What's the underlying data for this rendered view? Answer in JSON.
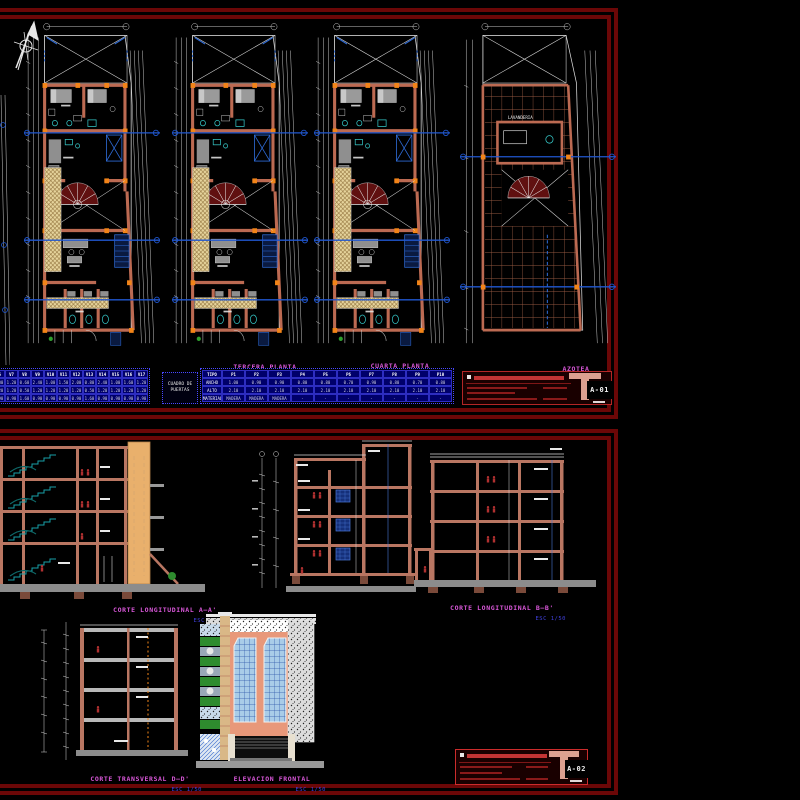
{
  "sheet1": {
    "plans": [
      {
        "title": "",
        "scale": "ESC 1/50"
      },
      {
        "title": "TERCERA PLANTA",
        "scale": "ESC 1/50"
      },
      {
        "title": "CUARTA PLANTA",
        "scale": "ESC 1/50"
      },
      {
        "title": "AZOTEA",
        "scale": "ESC 1/50"
      }
    ],
    "azotea_room_label": "LAVANDERIA",
    "windows_table": {
      "rows": [
        [
          "V6",
          "V7",
          "V8",
          "V9",
          "V10",
          "V11",
          "V12",
          "V13",
          "V14",
          "V15",
          "V16",
          "V17"
        ],
        [
          "1.00",
          "1.20",
          "0.60",
          "2.40",
          "1.00",
          "1.50",
          "2.00",
          "0.80",
          "2.40",
          "1.00",
          "1.60",
          "1.20"
        ],
        [
          "1.20",
          "1.20",
          "0.50",
          "1.20",
          "1.20",
          "1.20",
          "1.20",
          "0.50",
          "1.20",
          "1.20",
          "1.20",
          "1.20"
        ],
        [
          "0.90",
          "0.90",
          "1.60",
          "0.90",
          "0.90",
          "0.90",
          "0.90",
          "1.60",
          "0.90",
          "0.90",
          "0.90",
          "0.90"
        ]
      ]
    },
    "doors_table": {
      "label": "CUADRO DE PUERTAS",
      "rows": [
        [
          "TIPO",
          "P1",
          "P2",
          "P3",
          "P4",
          "P5",
          "P6",
          "P7",
          "P8",
          "P9",
          "P10"
        ],
        [
          "ANCHO",
          "1.00",
          "0.90",
          "0.90",
          "0.80",
          "0.80",
          "0.70",
          "0.90",
          "0.80",
          "0.70",
          "0.80"
        ],
        [
          "ALTO",
          "2.10",
          "2.10",
          "2.10",
          "2.10",
          "2.10",
          "2.10",
          "2.10",
          "2.10",
          "2.10",
          "2.10"
        ],
        [
          "MATERIAL",
          "MADERA",
          "MADERA",
          "MADERA",
          "-",
          "-",
          "-",
          "-",
          "-",
          "-",
          "-"
        ]
      ]
    },
    "titleblock": {
      "sheet_no": "A-01"
    }
  },
  "sheet2": {
    "sections": [
      {
        "title": "CORTE LONGITUDINAL  A—A'",
        "scale": "ESC 1/50"
      },
      {
        "title": "CORTE LONGITUDINAL  B—B'",
        "scale": "ESC 1/50"
      },
      {
        "title": "CORTE TRANSVERSAL D—D'",
        "scale": "ESC 1/50"
      },
      {
        "title": "ELEVACION FRONTAL",
        "scale": "ESC 1/50"
      }
    ],
    "titleblock": {
      "sheet_no": "A-02"
    }
  },
  "colors": {
    "background": "#000000",
    "sheet_border": "#6b0707",
    "label_magenta": "#d957d9",
    "scale_blue": "#4040dd",
    "wall_salmon": "#bc6a52",
    "column_orange": "#f28418",
    "centerline_blue": "#2057d0",
    "table_navy": "#00006a",
    "stair_teal": "#18a0a8"
  }
}
